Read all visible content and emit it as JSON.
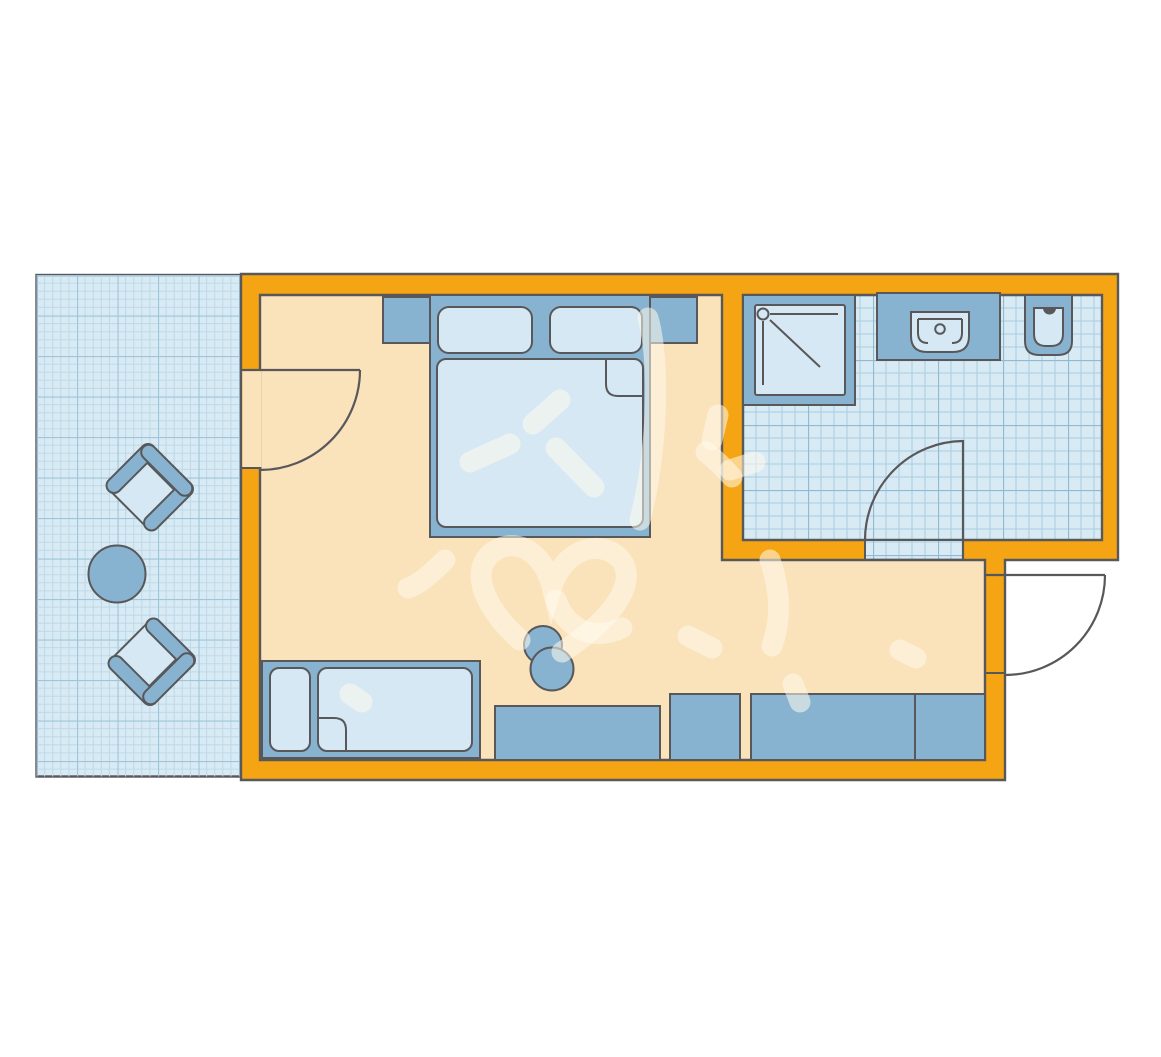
{
  "title": "Hotel room floor plan",
  "colors": {
    "background": "#FFFFFF",
    "wall": "#F5A513",
    "outline": "#58585A",
    "floor": "#FAE2BB",
    "furniture": "#87B3D1",
    "furnitureLight": "#D5E8F4",
    "balconyFloor": "#D8EAF4",
    "balconyGridMinor": "#BDD9E8",
    "balconyGridMajor": "#9EC5DA",
    "bathFloor": "#D8EAF4",
    "bathGridMinor": "#A9CCE0",
    "bathGridMajor": "#90B9D2",
    "watermark": "rgba(255,249,237,0.55)"
  },
  "rooms": [
    {
      "id": "balcony",
      "name": "balcony with tiled floor"
    },
    {
      "id": "bedroom",
      "name": "bedroom / living area"
    },
    {
      "id": "bathroom",
      "name": "bathroom with tiled floor"
    }
  ],
  "furniture": {
    "bedroom": [
      "double bed",
      "pillow left",
      "pillow right",
      "duvet with folded corner",
      "nightstand left",
      "nightstand right",
      "sofa bed with pillow",
      "desk",
      "desk chair",
      "cabinet",
      "sideboard",
      "wardrobe"
    ],
    "bathroom": [
      "shower",
      "washbasin on counter",
      "toilet"
    ],
    "balcony": [
      "armchair upper",
      "round table",
      "armchair lower"
    ],
    "doors": [
      "balcony door (opens into room)",
      "bathroom door (opens into bathroom)",
      "entrance door (opens outward)"
    ]
  }
}
